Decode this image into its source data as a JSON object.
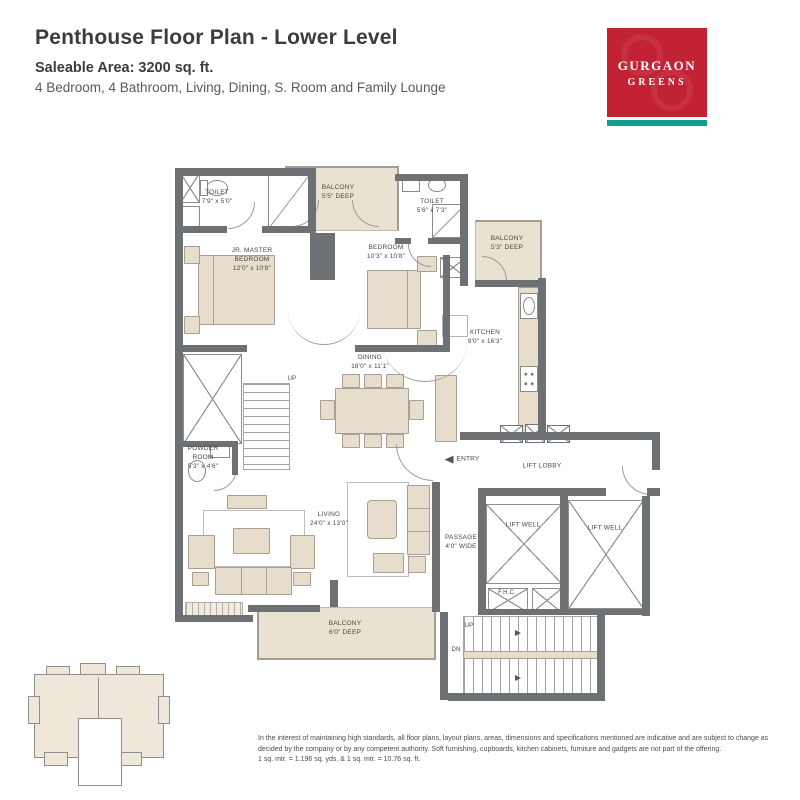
{
  "header": {
    "title": "Penthouse Floor Plan - Lower Level",
    "saleable_area": "Saleable Area: 3200 sq. ft.",
    "description": "4 Bedroom, 4 Bathroom, Living, Dining, S. Room and Family Lounge"
  },
  "logo": {
    "name_line1": "GURGAON",
    "name_line2": "GREENS",
    "bg_color": "#c32134",
    "stripe_color": "#139e8e"
  },
  "plan": {
    "rooms": {
      "toilet_top_left": {
        "lines": [
          "TOILET",
          "7'9\" x 5'0\""
        ]
      },
      "balcony_top": {
        "lines": [
          "BALCONY",
          "5'5\" DEEP"
        ]
      },
      "toilet_top_right": {
        "lines": [
          "TOILET",
          "5'6\" x 7'3\""
        ]
      },
      "balcony_right": {
        "lines": [
          "BALCONY",
          "5'3\" DEEP"
        ]
      },
      "jr_master_bedroom": {
        "lines": [
          "JR. MASTER",
          "BEDROOM",
          "12'0\" x 10'8\""
        ]
      },
      "bedroom": {
        "lines": [
          "BEDROOM",
          "10'3\" x 10'8\""
        ]
      },
      "kitchen": {
        "lines": [
          "KITCHEN",
          "9'0\" x 16'3\""
        ]
      },
      "dining": {
        "lines": [
          "DINING",
          "18'0\" x 11'1\""
        ]
      },
      "powder_room": {
        "lines": [
          "POWDER",
          "ROOM",
          "5'3\" x 4'6\""
        ]
      },
      "living": {
        "lines": [
          "LIVING",
          "24'0\" x 13'0\""
        ]
      },
      "passage": {
        "lines": [
          "PASSAGE",
          "4'0\" WIDE"
        ]
      },
      "balcony_bottom": {
        "lines": [
          "BALCONY",
          "6'0\" DEEP"
        ]
      },
      "lift_lobby": "LIFT LOBBY",
      "lift_well_1": "LIFT WELL",
      "lift_well_2": "LIFT WELL",
      "fhc": "F.H.C.",
      "entry": "ENTRY",
      "stairs_up_internal": "UP",
      "stairs_up": "UP",
      "stairs_dn": "DN"
    }
  },
  "disclaimer": {
    "text": "In the interest of maintaining high standards, all floor plans, layout plans, areas, dimensions and specifications mentioned are indicative and are subject to change as decided by the company or by any competent authority. Soft furnishing, cupboards, kitchen cabinets, furniture and gadgets are not part of the offering.",
    "conversion": "1 sq. mtr. = 1.196 sq. yds. & 1 sq. mtr. = 10.76 sq. ft."
  }
}
